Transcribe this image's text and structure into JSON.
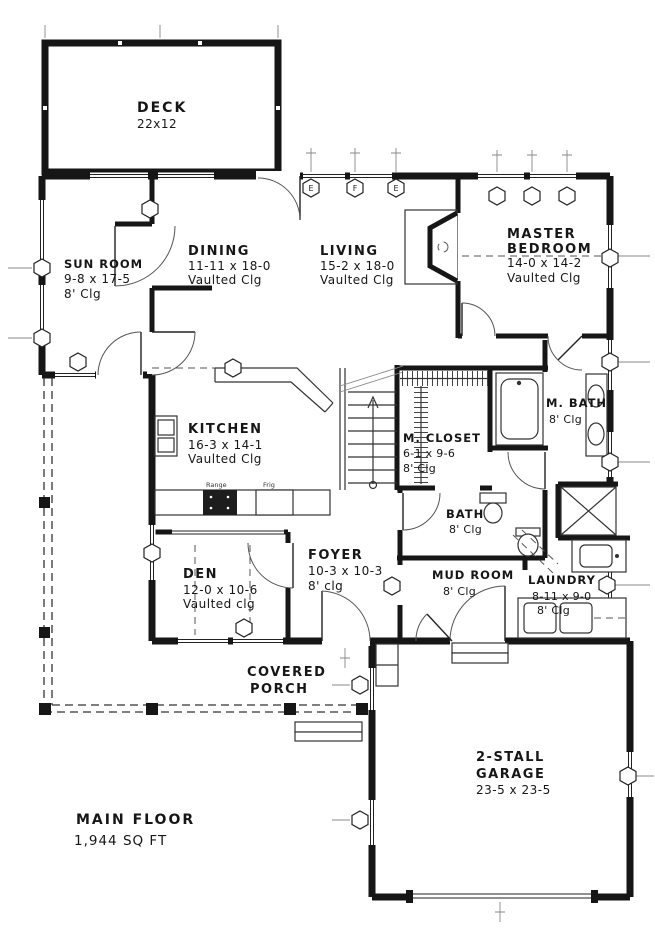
{
  "rooms": {
    "deck": {
      "name": "DECK",
      "dims": "22x12"
    },
    "sun_room": {
      "name": "SUN ROOM",
      "dims": "9-8 x 17-5",
      "clg": "8' Clg"
    },
    "dining": {
      "name": "DINING",
      "dims": "11-11 x 18-0",
      "clg": "Vaulted Clg"
    },
    "living": {
      "name": "LIVING",
      "dims": "15-2 x 18-0",
      "clg": "Vaulted Clg"
    },
    "master_bedroom": {
      "name": "MASTER",
      "name2": "BEDROOM",
      "dims": "14-0 x 14-2",
      "clg": "Vaulted Clg"
    },
    "kitchen": {
      "name": "KITCHEN",
      "dims": "16-3 x 14-1",
      "clg": "Vaulted Clg"
    },
    "m_closet": {
      "name": "M. CLOSET",
      "dims": "6-1 x 9-6",
      "clg": "8' Clg"
    },
    "m_bath": {
      "name": "M. BATH",
      "clg": "8' Clg"
    },
    "bath": {
      "name": "BATH",
      "clg": "8' Clg"
    },
    "den": {
      "name": "DEN",
      "dims": "12-0 x 10-6",
      "clg": "Vaulted clg"
    },
    "foyer": {
      "name": "FOYER",
      "dims": "10-3 x 10-3",
      "clg": "8' clg"
    },
    "mud_room": {
      "name": "MUD ROOM",
      "clg": "8' Clg"
    },
    "laundry": {
      "name": "LAUNDRY",
      "dims": "8-11 x 9-0",
      "clg": "8' Clg"
    },
    "covered_porch": {
      "name": "COVERED",
      "name2": "PORCH"
    },
    "garage": {
      "name": "2-STALL",
      "name2": "GARAGE",
      "dims": "23-5 x 23-5"
    }
  },
  "appliances": {
    "range": "Range",
    "frig": "Frig"
  },
  "window_markers": {
    "e1": "E",
    "f": "F",
    "e2": "E"
  },
  "footer": {
    "floor": "MAIN FLOOR",
    "area": "1,944 SQ FT"
  },
  "colors": {
    "wall": "#161616",
    "line": "#333333",
    "bg": "#ffffff"
  }
}
